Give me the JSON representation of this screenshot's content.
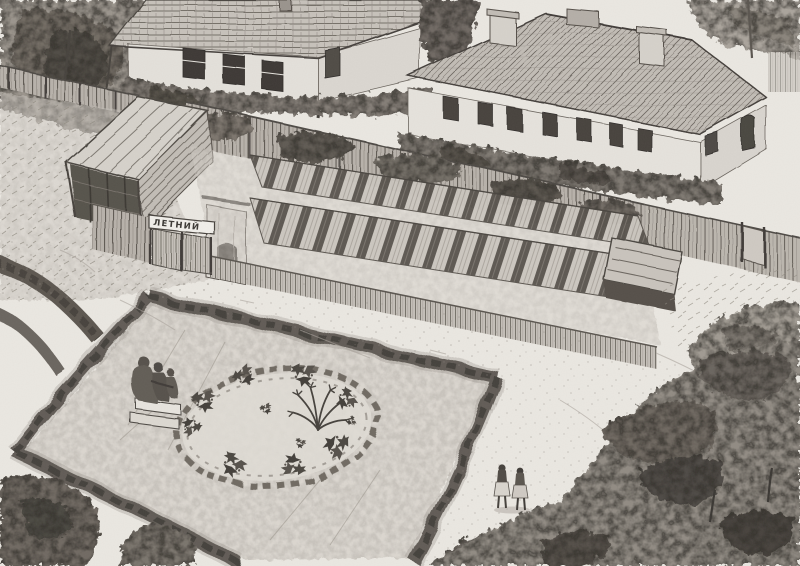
{
  "artwork": {
    "medium": "graphite pencil sketch",
    "subject": "aerial view of a courtyard garden with cold frames, two houses, hedge-bordered square with round flowerbed, bench figures and two strollers",
    "sign": {
      "text": "ЛЕТНИЙ"
    }
  },
  "palette": {
    "paper": "#ebe8e2",
    "graphite_light": "#c7c2bb",
    "graphite_mid": "#8d8780",
    "graphite_dark": "#55504a",
    "graphite_darkest": "#3a3733"
  },
  "scene": {
    "left_house": {
      "front_windows": 3,
      "side_windows": 1
    },
    "right_house": {
      "front_windows": 7,
      "chimneys": 2
    },
    "cold_frame_rows": 2,
    "bench_figures": 3,
    "walking_figures": 2,
    "flower_clusters": 8
  }
}
